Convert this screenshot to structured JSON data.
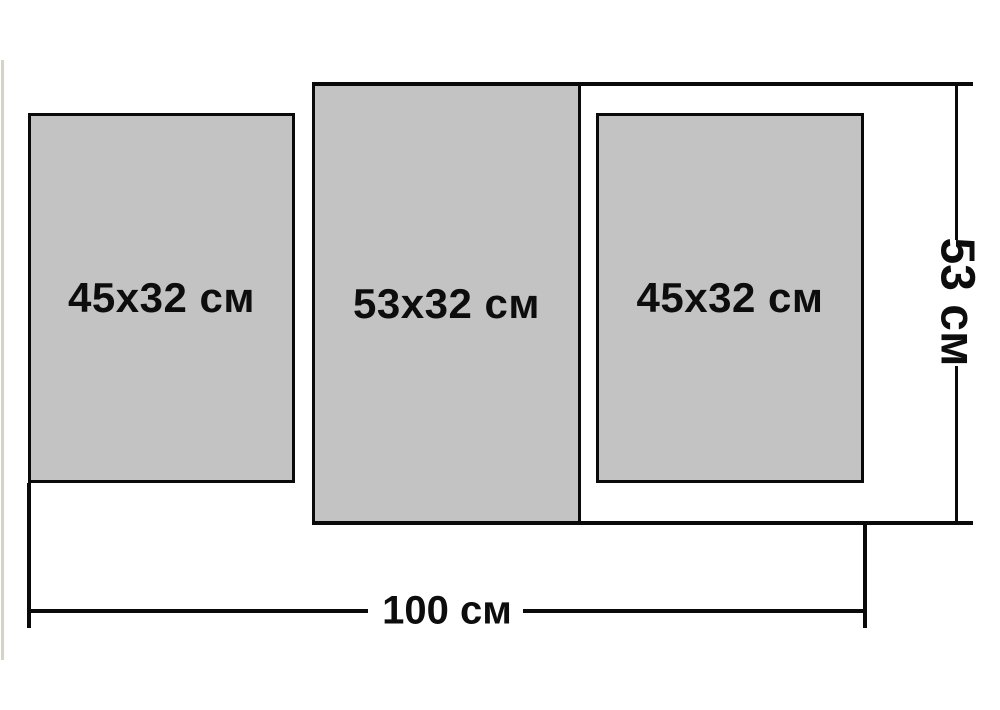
{
  "diagram": {
    "type": "modular-picture-size-scheme",
    "units": "см",
    "panels": [
      {
        "id": "left",
        "label": "45x32 см",
        "width_cm": 32,
        "height_cm": 45
      },
      {
        "id": "middle",
        "label": "53x32 см",
        "width_cm": 32,
        "height_cm": 53
      },
      {
        "id": "right",
        "label": "45x32 см",
        "width_cm": 32,
        "height_cm": 45
      }
    ],
    "overall": {
      "width_label": "100 см",
      "width_cm": 100,
      "height_label": "53 см",
      "height_cm": 53
    },
    "colors": {
      "panel_fill": "#c3c3c3",
      "line": "#0a0a0a",
      "text": "#0d0d0d",
      "background": "#ffffff",
      "artifact_line": "#d6d1c9"
    }
  }
}
